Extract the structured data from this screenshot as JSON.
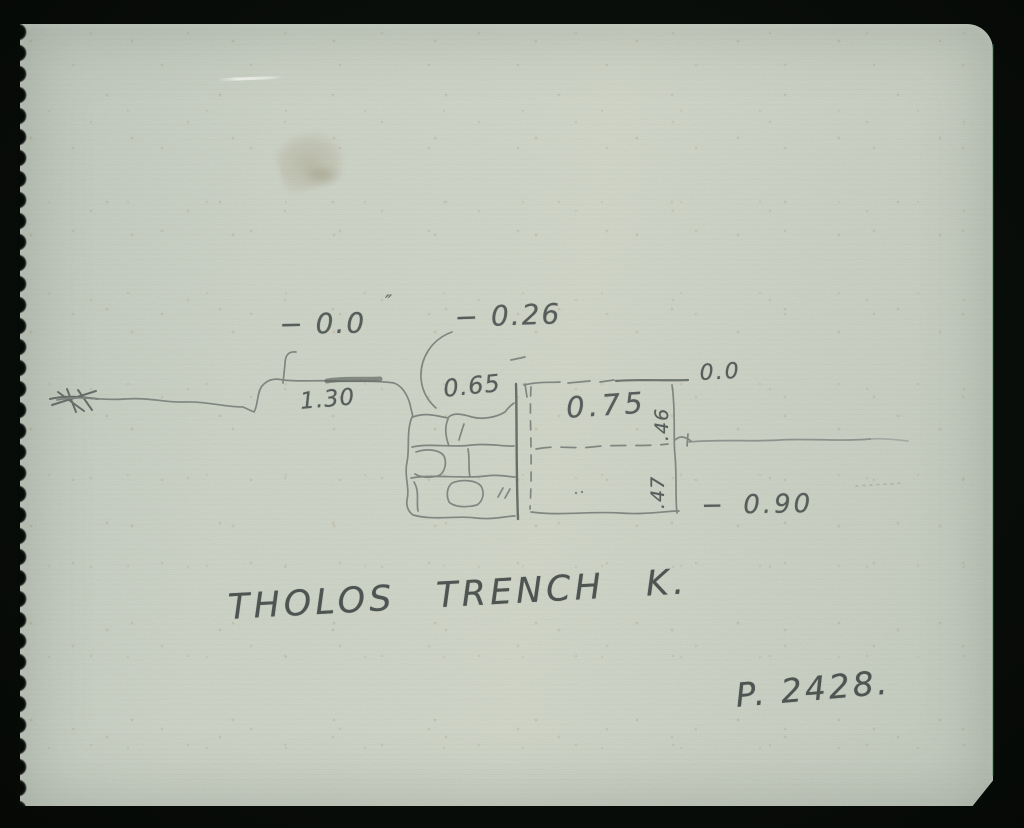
{
  "photo": {
    "background_color": "#0a0e0a",
    "paper_color": "#cfd5c9",
    "pencil_color": "#565d5a"
  },
  "sketch": {
    "kind": "hand-drawn trench section",
    "measurements": {
      "datum_left": "− 0.0",
      "ditto_mark": "″",
      "step_level": "− 0.26",
      "wall_height": "0.65",
      "shelf_width": "1.30",
      "fill_width": "0.75",
      "datum_right": "0.0",
      "upper_depth": ".46",
      "lower_depth": ".47",
      "bottom_level": "− 0.90"
    },
    "caption": "THOLOS TRENCH K.",
    "page_ref": "P. 2428."
  }
}
